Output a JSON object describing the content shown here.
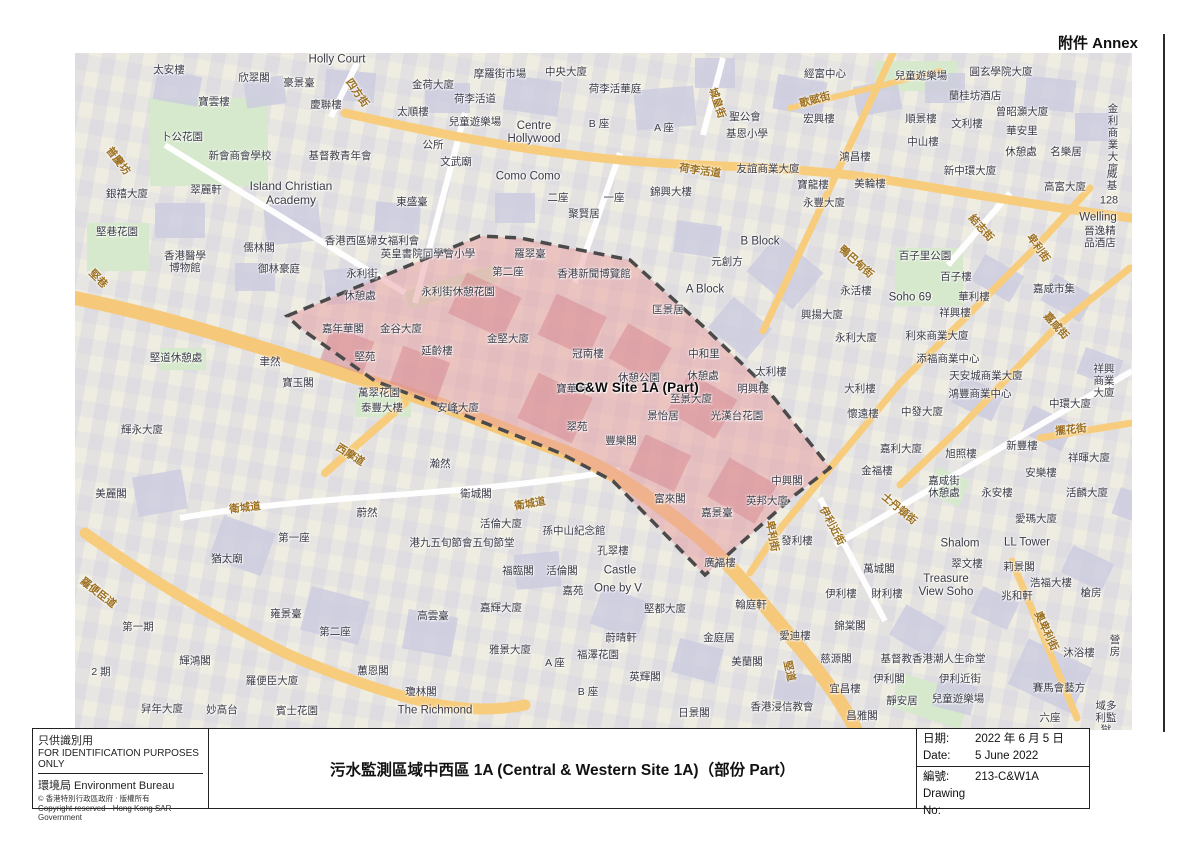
{
  "annex": "附件 Annex",
  "colors": {
    "site_fill": "#e79ba0",
    "site_boundary": "#4a4a4a",
    "road_major": "#f7cd7d",
    "road_minor": "#ffffff",
    "park_green": "#d6e9cc",
    "building_fill": "#cdcde0",
    "street_text": "#9c7020",
    "label_text": "#3b3b47"
  },
  "footer": {
    "left": {
      "line1": "只供識別用",
      "line2": "FOR IDENTIFICATION PURPOSES ONLY",
      "dept": "環境局  Environment Bureau",
      "copy1": "©  香港特別行政區政府 ‧ 版權所有",
      "copy2": "Copyright reserved - Hong Kong SAR Government"
    },
    "title": "污水監測區域中西區 1A (Central & Western Site 1A)（部份 Part）",
    "right": {
      "rows": [
        {
          "k": "日期:",
          "v": "2022 年 6 月 5 日"
        },
        {
          "k": "Date:",
          "v": "5 June 2022"
        },
        {
          "k": "編號:",
          "v": "213-C&W1A"
        },
        {
          "k": "Drawing No:",
          "v": ""
        }
      ]
    }
  },
  "map": {
    "site_label": "C&W Site 1A (Part)",
    "labels": [
      {
        "t": "太安樓",
        "x": 169,
        "y": 70
      },
      {
        "t": "欣翠閣",
        "x": 254,
        "y": 78
      },
      {
        "t": "豪景臺",
        "x": 299,
        "y": 83
      },
      {
        "t": "Holly Court",
        "x": 337,
        "y": 60,
        "fs": 11.5
      },
      {
        "t": "四方街",
        "x": 357,
        "y": 93,
        "c": "s",
        "r": 55
      },
      {
        "t": "金荷大廈",
        "x": 433,
        "y": 85
      },
      {
        "t": "寶雲樓",
        "x": 214,
        "y": 102
      },
      {
        "t": "慶聯樓",
        "x": 326,
        "y": 105
      },
      {
        "t": "太順樓",
        "x": 413,
        "y": 112
      },
      {
        "t": "荷李活道",
        "x": 475,
        "y": 99
      },
      {
        "t": "摩羅街市場",
        "x": 500,
        "y": 74
      },
      {
        "t": "中央大廈",
        "x": 566,
        "y": 72
      },
      {
        "t": "荷李活華庭",
        "x": 615,
        "y": 89
      },
      {
        "t": "兒童遊樂場",
        "x": 475,
        "y": 122
      },
      {
        "t": "Centre\nHollywood",
        "x": 534,
        "y": 133,
        "fs": 11.5
      },
      {
        "t": "B 座",
        "x": 599,
        "y": 124
      },
      {
        "t": "A 座",
        "x": 664,
        "y": 128
      },
      {
        "t": "卜公花園",
        "x": 182,
        "y": 137
      },
      {
        "t": "新會商會學校",
        "x": 240,
        "y": 156
      },
      {
        "t": "基督教青年會",
        "x": 340,
        "y": 156
      },
      {
        "t": "公所",
        "x": 433,
        "y": 145
      },
      {
        "t": "文武廟",
        "x": 456,
        "y": 162
      },
      {
        "t": "普慶坊",
        "x": 118,
        "y": 161,
        "c": "s",
        "r": 52
      },
      {
        "t": "翠麗軒",
        "x": 206,
        "y": 190
      },
      {
        "t": "Island Christian\nAcademy",
        "x": 291,
        "y": 194,
        "fs": 12
      },
      {
        "t": "東盛臺",
        "x": 412,
        "y": 202
      },
      {
        "t": "銀禧大廈",
        "x": 127,
        "y": 194
      },
      {
        "t": "堅巷花園",
        "x": 117,
        "y": 232
      },
      {
        "t": "城皇街",
        "x": 717,
        "y": 103,
        "c": "s",
        "r": 72
      },
      {
        "t": "荷李活道",
        "x": 700,
        "y": 171,
        "c": "s",
        "r": 8
      },
      {
        "t": "二座",
        "x": 558,
        "y": 198
      },
      {
        "t": "一座",
        "x": 614,
        "y": 198
      },
      {
        "t": "Como Como",
        "x": 528,
        "y": 177,
        "fs": 11.5
      },
      {
        "t": "聚賢居",
        "x": 584,
        "y": 214
      },
      {
        "t": "錦興大樓",
        "x": 671,
        "y": 192
      },
      {
        "t": "友誼商業大廈",
        "x": 768,
        "y": 169
      },
      {
        "t": "聖公會",
        "x": 745,
        "y": 117
      },
      {
        "t": "基恩小學",
        "x": 747,
        "y": 134
      },
      {
        "t": "經富中心",
        "x": 825,
        "y": 74
      },
      {
        "t": "兒童遊樂場",
        "x": 921,
        "y": 76
      },
      {
        "t": "圓玄學院大廈",
        "x": 1001,
        "y": 72
      },
      {
        "t": "蘭桂坊酒店",
        "x": 975,
        "y": 96
      },
      {
        "t": "歌賦街",
        "x": 815,
        "y": 100,
        "c": "s",
        "r": -15
      },
      {
        "t": "宏興樓",
        "x": 819,
        "y": 119
      },
      {
        "t": "順景樓",
        "x": 921,
        "y": 119
      },
      {
        "t": "文利樓",
        "x": 967,
        "y": 124
      },
      {
        "t": "曾昭灝大廈",
        "x": 1022,
        "y": 112
      },
      {
        "t": "華安里",
        "x": 1022,
        "y": 131
      },
      {
        "t": "休憩處",
        "x": 1021,
        "y": 152
      },
      {
        "t": "名樂居",
        "x": 1066,
        "y": 152
      },
      {
        "t": "金利商業大廈",
        "x": 1113,
        "y": 139
      },
      {
        "t": "中山樓",
        "x": 923,
        "y": 142
      },
      {
        "t": "鴻昌樓",
        "x": 855,
        "y": 157
      },
      {
        "t": "新中環大廈",
        "x": 970,
        "y": 171
      },
      {
        "t": "寶龍樓",
        "x": 813,
        "y": 185
      },
      {
        "t": "美輪樓",
        "x": 870,
        "y": 184
      },
      {
        "t": "永豐大廈",
        "x": 824,
        "y": 203
      },
      {
        "t": "高富大廈",
        "x": 1065,
        "y": 187
      },
      {
        "t": "威基",
        "x": 1112,
        "y": 180
      },
      {
        "t": "128",
        "x": 1109,
        "y": 201,
        "fs": 11
      },
      {
        "t": "Welling",
        "x": 1098,
        "y": 218,
        "fs": 11.5
      },
      {
        "t": "晉逸精品酒店",
        "x": 1100,
        "y": 237
      },
      {
        "t": "卑利街",
        "x": 1038,
        "y": 248,
        "c": "s",
        "r": 55
      },
      {
        "t": "結志街",
        "x": 981,
        "y": 228,
        "c": "s",
        "r": 48
      },
      {
        "t": "鴨巴甸街",
        "x": 856,
        "y": 262,
        "c": "s",
        "r": 42
      },
      {
        "t": "B Block",
        "x": 760,
        "y": 242,
        "fs": 11.5
      },
      {
        "t": "元創方",
        "x": 727,
        "y": 262
      },
      {
        "t": "A Block",
        "x": 705,
        "y": 290,
        "fs": 11.5
      },
      {
        "t": "永活樓",
        "x": 856,
        "y": 291
      },
      {
        "t": "興揚大廈",
        "x": 822,
        "y": 315
      },
      {
        "t": "永利大廈",
        "x": 856,
        "y": 338
      },
      {
        "t": "利來商業大廈",
        "x": 937,
        "y": 336
      },
      {
        "t": "百子里公園",
        "x": 925,
        "y": 256
      },
      {
        "t": "百子樓",
        "x": 956,
        "y": 277
      },
      {
        "t": "華利樓",
        "x": 974,
        "y": 297
      },
      {
        "t": "Soho 69",
        "x": 910,
        "y": 298,
        "fs": 11.5
      },
      {
        "t": "祥興樓",
        "x": 955,
        "y": 313
      },
      {
        "t": "嘉咸市集",
        "x": 1054,
        "y": 289
      },
      {
        "t": "嘉咸街",
        "x": 1056,
        "y": 326,
        "c": "s",
        "r": 48
      },
      {
        "t": "添福商業中心",
        "x": 948,
        "y": 359
      },
      {
        "t": "天安城商業大廈",
        "x": 986,
        "y": 376
      },
      {
        "t": "鴻豐商業中心",
        "x": 980,
        "y": 394
      },
      {
        "t": "祥興商業大廈",
        "x": 1104,
        "y": 381
      },
      {
        "t": "中發大廈",
        "x": 922,
        "y": 412
      },
      {
        "t": "中環大廈",
        "x": 1070,
        "y": 404
      },
      {
        "t": "擺花街",
        "x": 1071,
        "y": 430,
        "c": "s",
        "r": -6
      },
      {
        "t": "懷遠樓",
        "x": 863,
        "y": 414
      },
      {
        "t": "大利樓",
        "x": 860,
        "y": 389
      },
      {
        "t": "太利樓",
        "x": 771,
        "y": 372
      },
      {
        "t": "香港西區婦女福利會",
        "x": 372,
        "y": 241
      },
      {
        "t": "英皇書院同學會小學",
        "x": 428,
        "y": 254
      },
      {
        "t": "儒林閣",
        "x": 259,
        "y": 248
      },
      {
        "t": "御林豪庭",
        "x": 279,
        "y": 269
      },
      {
        "t": "香港醫學\n博物館",
        "x": 185,
        "y": 262
      },
      {
        "t": "堅巷",
        "x": 98,
        "y": 279,
        "c": "s",
        "r": 45
      },
      {
        "t": "永利街",
        "x": 362,
        "y": 274
      },
      {
        "t": "休憩處",
        "x": 360,
        "y": 296
      },
      {
        "t": "羅翠臺",
        "x": 530,
        "y": 254
      },
      {
        "t": "第二座",
        "x": 508,
        "y": 272
      },
      {
        "t": "永利街休憩花園",
        "x": 458,
        "y": 292
      },
      {
        "t": "香港新聞博覽館",
        "x": 594,
        "y": 274
      },
      {
        "t": "匡景居",
        "x": 668,
        "y": 310
      },
      {
        "t": "嘉年華閣",
        "x": 343,
        "y": 329
      },
      {
        "t": "金谷大廈",
        "x": 401,
        "y": 329
      },
      {
        "t": "堅苑",
        "x": 365,
        "y": 357
      },
      {
        "t": "延齡樓",
        "x": 437,
        "y": 351
      },
      {
        "t": "金堅大廈",
        "x": 508,
        "y": 339
      },
      {
        "t": "冠南樓",
        "x": 588,
        "y": 354
      },
      {
        "t": "中和里",
        "x": 704,
        "y": 354
      },
      {
        "t": "休憩處",
        "x": 703,
        "y": 376
      },
      {
        "t": "明興樓",
        "x": 753,
        "y": 389
      },
      {
        "t": "至景大廈",
        "x": 691,
        "y": 399
      },
      {
        "t": "休憩公園",
        "x": 639,
        "y": 378
      },
      {
        "t": "寶華軒",
        "x": 572,
        "y": 389
      },
      {
        "t": "C&W Site 1A (Part)",
        "x": 637,
        "y": 388,
        "c": "site"
      },
      {
        "t": "景怡居",
        "x": 663,
        "y": 416
      },
      {
        "t": "光漢台花園",
        "x": 737,
        "y": 416
      },
      {
        "t": "翠苑",
        "x": 577,
        "y": 427
      },
      {
        "t": "豐樂閣",
        "x": 621,
        "y": 441
      },
      {
        "t": "堅道休憩處",
        "x": 176,
        "y": 358
      },
      {
        "t": "聿然",
        "x": 270,
        "y": 362
      },
      {
        "t": "寶玉閣",
        "x": 298,
        "y": 383
      },
      {
        "t": "萬翠花園",
        "x": 379,
        "y": 393
      },
      {
        "t": "泰豐大樓",
        "x": 382,
        "y": 408
      },
      {
        "t": "安峰大廈",
        "x": 458,
        "y": 408
      },
      {
        "t": "輝永大廈",
        "x": 142,
        "y": 430
      },
      {
        "t": "西摩道",
        "x": 350,
        "y": 455,
        "c": "s",
        "r": 32
      },
      {
        "t": "瀚然",
        "x": 440,
        "y": 464
      },
      {
        "t": "美麗閣",
        "x": 111,
        "y": 494
      },
      {
        "t": "衛城道",
        "x": 245,
        "y": 508,
        "c": "s",
        "r": -6
      },
      {
        "t": "衛城道",
        "x": 530,
        "y": 504,
        "c": "s",
        "r": -10
      },
      {
        "t": "衛城閣",
        "x": 476,
        "y": 494
      },
      {
        "t": "蔚然",
        "x": 367,
        "y": 513
      },
      {
        "t": "第一座",
        "x": 294,
        "y": 538
      },
      {
        "t": "猶太廟",
        "x": 227,
        "y": 559
      },
      {
        "t": "羅便臣道",
        "x": 98,
        "y": 593,
        "c": "s",
        "r": 38
      },
      {
        "t": "港九五旬節會五旬節堂",
        "x": 462,
        "y": 543
      },
      {
        "t": "活倫大廈",
        "x": 501,
        "y": 524
      },
      {
        "t": "孫中山紀念館",
        "x": 574,
        "y": 531
      },
      {
        "t": "孔翠樓",
        "x": 613,
        "y": 551
      },
      {
        "t": "福臨閣",
        "x": 518,
        "y": 571
      },
      {
        "t": "活倫閣",
        "x": 562,
        "y": 571
      },
      {
        "t": "Castle",
        "x": 620,
        "y": 571,
        "fs": 11.5
      },
      {
        "t": "嘉苑",
        "x": 573,
        "y": 591
      },
      {
        "t": "One by V",
        "x": 618,
        "y": 589,
        "fs": 11.5
      },
      {
        "t": "堅都大廈",
        "x": 665,
        "y": 609
      },
      {
        "t": "富來閣",
        "x": 670,
        "y": 499
      },
      {
        "t": "嘉景臺",
        "x": 717,
        "y": 513
      },
      {
        "t": "英邦大廈",
        "x": 767,
        "y": 501
      },
      {
        "t": "中興閣",
        "x": 787,
        "y": 481
      },
      {
        "t": "廣福樓",
        "x": 720,
        "y": 563
      },
      {
        "t": "卑利街",
        "x": 772,
        "y": 536,
        "c": "s",
        "r": 80
      },
      {
        "t": "伊利近街",
        "x": 832,
        "y": 526,
        "c": "s",
        "r": 62
      },
      {
        "t": "士丹頓街",
        "x": 899,
        "y": 509,
        "c": "s",
        "r": 40
      },
      {
        "t": "發利樓",
        "x": 797,
        "y": 541
      },
      {
        "t": "金福樓",
        "x": 877,
        "y": 471
      },
      {
        "t": "嘉利大廈",
        "x": 901,
        "y": 449
      },
      {
        "t": "旭照樓",
        "x": 961,
        "y": 454
      },
      {
        "t": "新豐樓",
        "x": 1022,
        "y": 446
      },
      {
        "t": "祥暉大廈",
        "x": 1089,
        "y": 458
      },
      {
        "t": "安樂樓",
        "x": 1041,
        "y": 473
      },
      {
        "t": "永安樓",
        "x": 997,
        "y": 493
      },
      {
        "t": "活麟大廈",
        "x": 1087,
        "y": 493
      },
      {
        "t": "嘉咸街\n休憩處",
        "x": 944,
        "y": 487
      },
      {
        "t": "愛瑪大廈",
        "x": 1036,
        "y": 519
      },
      {
        "t": "Shalom",
        "x": 960,
        "y": 544,
        "fs": 11.5
      },
      {
        "t": "LL Tower",
        "x": 1027,
        "y": 543,
        "fs": 11.5
      },
      {
        "t": "翠文樓",
        "x": 967,
        "y": 564
      },
      {
        "t": "莉景閣",
        "x": 1019,
        "y": 567
      },
      {
        "t": "萬城閣",
        "x": 879,
        "y": 569
      },
      {
        "t": "Treasure\nView Soho",
        "x": 946,
        "y": 586,
        "fs": 11.5
      },
      {
        "t": "浩福大樓",
        "x": 1051,
        "y": 583
      },
      {
        "t": "兆和軒",
        "x": 1017,
        "y": 596
      },
      {
        "t": "伊利樓",
        "x": 841,
        "y": 594
      },
      {
        "t": "財利樓",
        "x": 887,
        "y": 594
      },
      {
        "t": "槍房",
        "x": 1091,
        "y": 593
      },
      {
        "t": "翰庭軒",
        "x": 751,
        "y": 605
      },
      {
        "t": "金庭居",
        "x": 719,
        "y": 638
      },
      {
        "t": "愛迪樓",
        "x": 795,
        "y": 636
      },
      {
        "t": "美蘭閣",
        "x": 747,
        "y": 662
      },
      {
        "t": "堅道",
        "x": 789,
        "y": 671,
        "c": "s",
        "r": 78
      },
      {
        "t": "蔚晴軒",
        "x": 621,
        "y": 638
      },
      {
        "t": "福澤花園",
        "x": 598,
        "y": 655
      },
      {
        "t": "A 座",
        "x": 555,
        "y": 663
      },
      {
        "t": "B 座",
        "x": 588,
        "y": 692
      },
      {
        "t": "英輝閣",
        "x": 645,
        "y": 677
      },
      {
        "t": "雅景大廈",
        "x": 510,
        "y": 650
      },
      {
        "t": "嘉輝大廈",
        "x": 501,
        "y": 608
      },
      {
        "t": "高雲臺",
        "x": 433,
        "y": 616
      },
      {
        "t": "雍景臺",
        "x": 286,
        "y": 614
      },
      {
        "t": "第二座",
        "x": 335,
        "y": 632
      },
      {
        "t": "蕙恩閣",
        "x": 373,
        "y": 671
      },
      {
        "t": "瓊林閣",
        "x": 421,
        "y": 692
      },
      {
        "t": "The Richmond",
        "x": 435,
        "y": 711,
        "fs": 11.5
      },
      {
        "t": "賓士花園",
        "x": 297,
        "y": 711
      },
      {
        "t": "妙高台",
        "x": 222,
        "y": 710
      },
      {
        "t": "舁年大廈",
        "x": 162,
        "y": 709
      },
      {
        "t": "輝鴻閣",
        "x": 195,
        "y": 661
      },
      {
        "t": "第一期",
        "x": 138,
        "y": 627
      },
      {
        "t": "2 期",
        "x": 101,
        "y": 672
      },
      {
        "t": "羅便臣大廈",
        "x": 272,
        "y": 681
      },
      {
        "t": "日景閣",
        "x": 694,
        "y": 713
      },
      {
        "t": "香港浸信教會",
        "x": 782,
        "y": 707
      },
      {
        "t": "錦棠閣",
        "x": 850,
        "y": 626
      },
      {
        "t": "慈源閣",
        "x": 836,
        "y": 659
      },
      {
        "t": "基督教香港潮人生命堂",
        "x": 933,
        "y": 659
      },
      {
        "t": "伊利閣",
        "x": 889,
        "y": 679
      },
      {
        "t": "伊利近街",
        "x": 960,
        "y": 679
      },
      {
        "t": "兒童遊樂場",
        "x": 958,
        "y": 699
      },
      {
        "t": "靜安居",
        "x": 902,
        "y": 701
      },
      {
        "t": "宜昌樓",
        "x": 845,
        "y": 689
      },
      {
        "t": "昌雅閣",
        "x": 862,
        "y": 716
      },
      {
        "t": "奧卑利街",
        "x": 1046,
        "y": 631,
        "c": "s",
        "r": 65
      },
      {
        "t": "沐浴樓",
        "x": 1079,
        "y": 653
      },
      {
        "t": "營房",
        "x": 1115,
        "y": 646
      },
      {
        "t": "賽馬會藝方",
        "x": 1059,
        "y": 688
      },
      {
        "t": "六座",
        "x": 1050,
        "y": 718
      },
      {
        "t": "域多利監獄",
        "x": 1106,
        "y": 718
      }
    ]
  }
}
